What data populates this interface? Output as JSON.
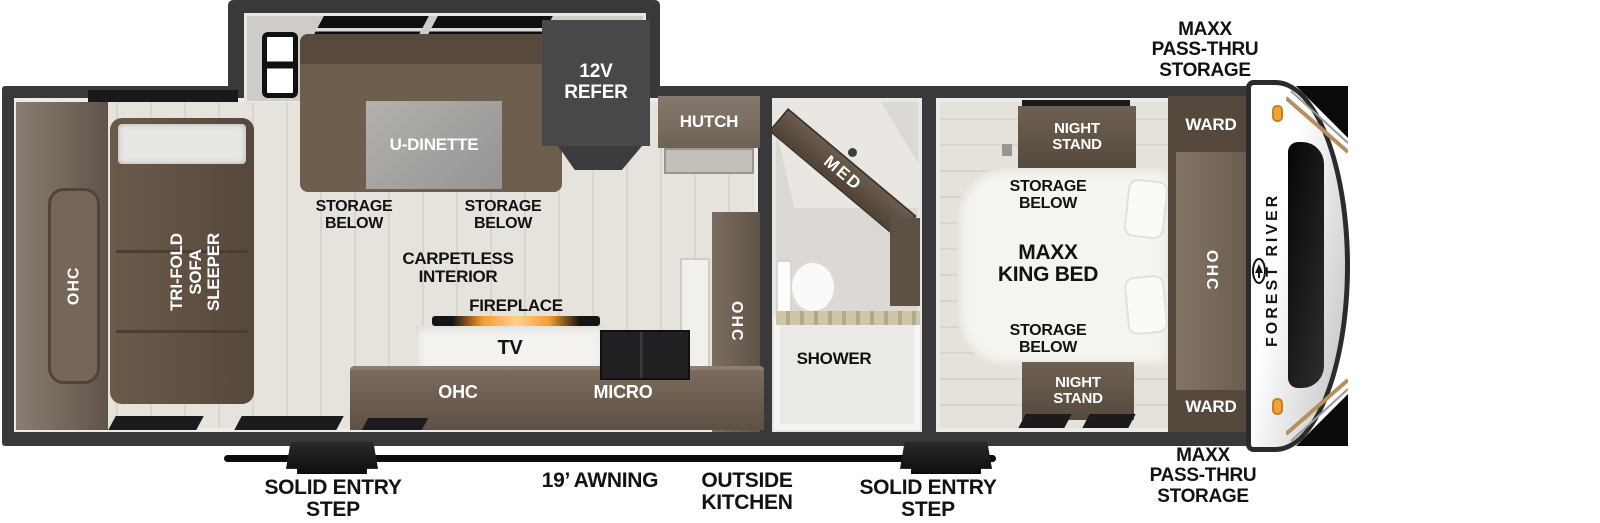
{
  "title": "Forest River travel trailer floor plan",
  "colors": {
    "wall_dark": "#39393b",
    "floor": "#e6e2dc",
    "furniture_brown": "#60544a",
    "furniture_brown_dark": "#4f4337",
    "refer_gray": "#48484a",
    "table_gray": "#a9a7a4",
    "white_surface": "#f4f2ef",
    "marker_amber": "#f0a339",
    "decal_tan": "#b5905e",
    "label_black": "#121212",
    "label_white": "#ffffff"
  },
  "exterior": {
    "storage_front_top": "MAXX\nPASS-THRU\nSTORAGE",
    "storage_front_bottom": "MAXX\nPASS-THRU\nSTORAGE",
    "awning": "19’ AWNING",
    "outside_kitchen": "OUTSIDE\nKITCHEN",
    "entry_step_left": "SOLID ENTRY\nSTEP",
    "entry_step_right": "SOLID ENTRY\nSTEP",
    "brand": "FOREST RIVER"
  },
  "rear": {
    "ohc": "OHC",
    "sofa": "TRI-FOLD\nSOFA SLEEPER"
  },
  "dinette": {
    "label": "U-DINETTE",
    "storage_left": "STORAGE\nBELOW",
    "storage_right": "STORAGE\nBELOW",
    "refer": "12V\nREFER"
  },
  "kitchen": {
    "hutch": "HUTCH",
    "carpetless": "CARPETLESS\nINTERIOR",
    "fireplace": "FIREPLACE",
    "tv": "TV",
    "ohc_lower": "OHC",
    "micro": "MICRO",
    "ohc_pantry": "OHC"
  },
  "bath": {
    "med": "MED",
    "shower": "SHOWER"
  },
  "bedroom": {
    "night_stand_top": "NIGHT\nSTAND",
    "storage_top": "STORAGE\nBELOW",
    "bed": "MAXX\nKING BED",
    "storage_bottom": "STORAGE\nBELOW",
    "night_stand_bottom": "NIGHT\nSTAND",
    "ward_top": "WARD",
    "ward_bottom": "WARD",
    "ohc": "OHC"
  }
}
